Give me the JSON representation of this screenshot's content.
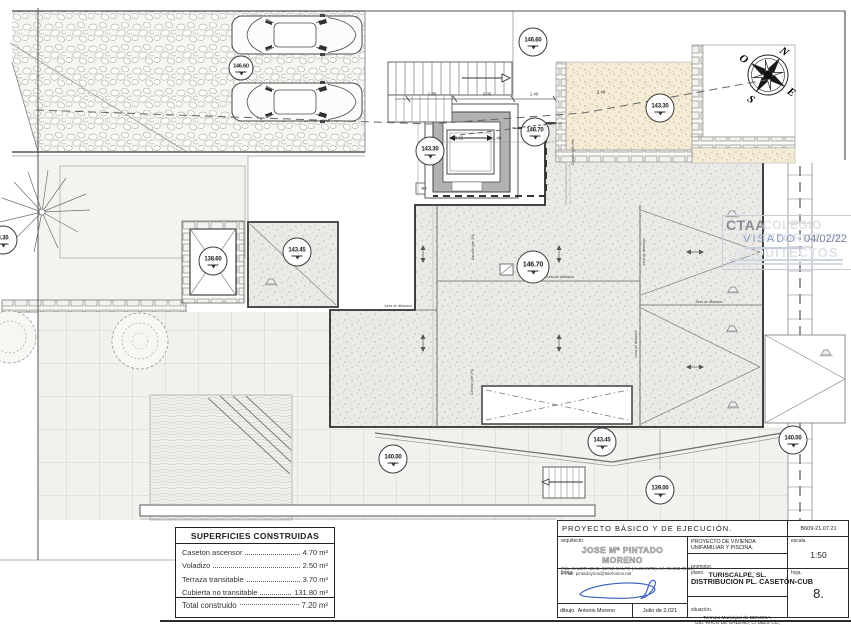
{
  "markers": [
    {
      "value": "146.60"
    },
    {
      "value": "146.60"
    },
    {
      "value": "143.30"
    },
    {
      "value": "146.70"
    },
    {
      "value": "143.30"
    },
    {
      "value": "143.45"
    },
    {
      "value": "138.60"
    },
    {
      "value": "3.30"
    },
    {
      "value": "146.70"
    },
    {
      "value": "140.00"
    },
    {
      "value": "143.45"
    },
    {
      "value": "139.00"
    },
    {
      "value": "140.00"
    }
  ],
  "dims": [
    "1.85",
    "2.05",
    "1.40",
    "3.40",
    "0.65",
    "1.40",
    "0.90",
    "2.30"
  ],
  "texts": {
    "junta": "Junta de dilatación",
    "canalon": "Canalón (pte 2%)",
    "d2": "D2"
  },
  "compass": {
    "n": "N",
    "s": "S",
    "e": "E",
    "o": "O"
  },
  "watermark": {
    "abbr": "CTAA",
    "line1": "COLEGIO",
    "line2": "TERRITORIAL DE",
    "line3": "ARQUITECTOS",
    "status": "VISADO",
    "date": "04/02/22"
  },
  "areas_table": {
    "title": "SUPERFICIES CONSTRUIDAS",
    "rows": [
      {
        "label": "Caseton ascensor",
        "value": "4.70 m²"
      },
      {
        "label": "Voladizo",
        "value": "2.50 m²"
      },
      {
        "label": "Terraza transitable",
        "value": "3.70 m²"
      },
      {
        "label": "Cubierta no transitable",
        "value": "131.80 m²"
      }
    ],
    "total": {
      "label": "Total construido",
      "value": "7.20 m²"
    }
  },
  "title_block": {
    "project_type": "PROYECTO  BÁSICO  Y  DE  EJECUCIÓN.",
    "ref": "B609-21.07.21",
    "architect_label": "arquitecto.",
    "architect_name": "JOSE Mª PINTADO MORENO",
    "architect_addr1": "Pda. CALETA 25-D, 03710 CALPE (ALICANTE), tel. 96 583 35 44,",
    "architect_addr2": "e-mail: pintadoyrios@telefonica.net",
    "project_title": "PROYECTO DE VIVIENDA UNIFAMILIAR Y PISCINA.",
    "promoter_label": "promotor.",
    "promoter": "TURISCALPE, SL.",
    "scale_label": "escala",
    "scale": "1:50",
    "signature_label": "firma.",
    "drawn_label": "dibujo.",
    "drawn_by": "Antonio Moreno",
    "date": "Julio de 2.021",
    "plan_label": "plano.",
    "plan_title": "DISTRIBUCION PL. CASETÓN-CUB",
    "location_label": "situación.",
    "location1": "Termino Municipal de BENISSA.",
    "location2": "Urb. RACO DE GALENO, C/ DELS CÓ, 2B.",
    "sheet_label": "hoja.",
    "sheet": "8."
  }
}
